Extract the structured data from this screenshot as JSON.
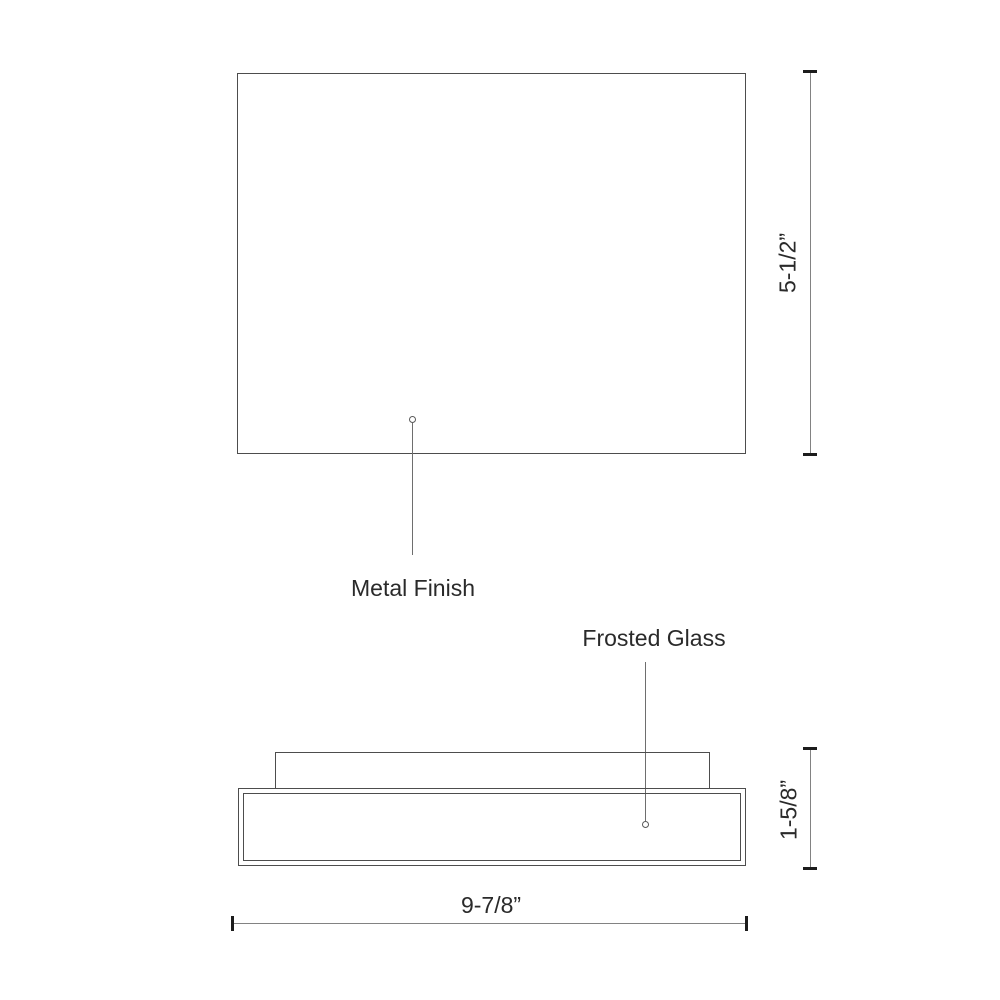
{
  "drawing": {
    "type": "product-dimension-drawing",
    "views": [
      {
        "id": "top-view",
        "description": "rectangular top view of fixture"
      },
      {
        "id": "side-profile-view",
        "description": "side profile with mounting plate and frosted glass diffuser"
      }
    ]
  },
  "labels": {
    "metal_finish": "Metal Finish",
    "frosted_glass": "Frosted Glass"
  },
  "dimensions": {
    "top_view_height": "5-1/2”",
    "side_view_height": "1-5/8”",
    "side_view_width": "9-7/8”"
  },
  "colors": {
    "background": "#ffffff",
    "outline": "#4d4d4d",
    "dimension_line": "#828282",
    "tick": "#1c1c1c",
    "leader_line": "#6e6e6e",
    "text": "#2a2a2a"
  }
}
